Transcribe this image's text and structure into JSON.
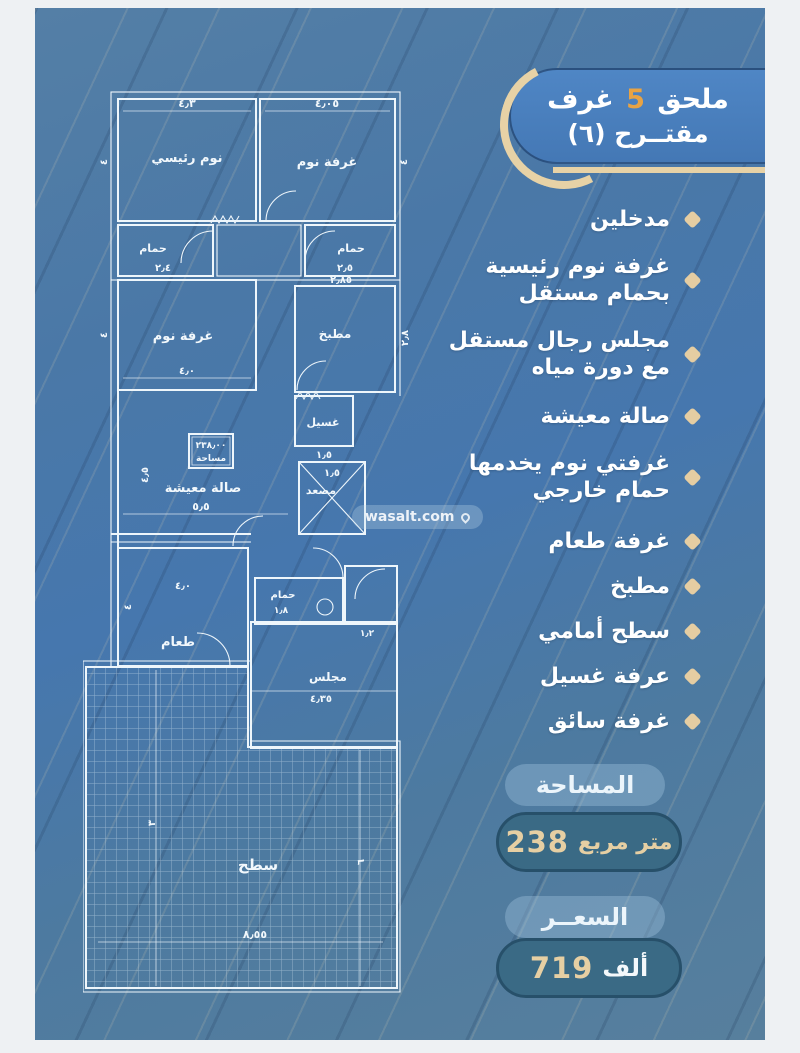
{
  "badge": {
    "line1_prefix": "ملحق",
    "line1_number": "5",
    "line1_suffix": "غرف",
    "line2": "مقتــرح (٦)"
  },
  "features": [
    "مدخلين",
    "غرفة نوم رئيسية\nبحمام مستقل",
    "مجلس رجال مستقل\nمع دورة مياه",
    "صالة معيشة",
    "غرفتي نوم يخدمها\nحمام خارجي",
    "غرفة طعام",
    "مطبخ",
    "سطح أمامي",
    "عرفة غسيل",
    "غرفة سائق"
  ],
  "area": {
    "label": "المساحة",
    "number": "238",
    "unit": "متر مربع"
  },
  "price": {
    "label": "السعــر",
    "number": "719",
    "unit": "ألف"
  },
  "watermark": "wasalt.com",
  "colors": {
    "accent_tan": "#e6cfa3",
    "number_orange": "#e8a344",
    "badge_blue": "#4b80bf",
    "pill_teal": "#3a6a85",
    "background_blue": "#4a78a7"
  },
  "floor_plan": {
    "area_box": {
      "line1": "٢٣٨٫٠٠",
      "line2": "مساحة"
    },
    "rooms": {
      "master_bedroom": {
        "label": "نوم رئيسي",
        "dim_top": "٤٫٣",
        "dim_side": "٤"
      },
      "bedroom_2": {
        "label": "غرفة نوم",
        "dim_top": "٤٫٠٥",
        "dim_side": "٤"
      },
      "bath_1": {
        "label": "حمام",
        "dim": "٢٫٤"
      },
      "bath_2": {
        "label": "حمام",
        "dim": "٢٫٥"
      },
      "kitchen": {
        "label": "مطبخ",
        "dim_top": "٢٫٨٥",
        "dim_side": "٢٫٨"
      },
      "bedroom_3": {
        "label": "غرفة نوم",
        "dim": "٤٫٠",
        "dim_side": "٤"
      },
      "laundry": {
        "label": "غسيل",
        "dim": "١٫٥"
      },
      "elevator": {
        "label": "مصعد",
        "dim": "١٫٥"
      },
      "living": {
        "label": "صالة معيشة",
        "dim": "٥٫٥",
        "dim_side": "٤٫٥"
      },
      "bath_3": {
        "label": "حمام",
        "dim": "١٫٨",
        "dim2": "١٫٢"
      },
      "dining": {
        "label": "طعام",
        "dim": "٤٫٠",
        "dim_side": "٤"
      },
      "majlis": {
        "label": "مجلس",
        "dim": "٤٫٣٥"
      },
      "roof": {
        "label": "سطح",
        "dim_bottom": "٨٫٥٥",
        "dim_left": "٣",
        "dim_right": "٦"
      }
    }
  }
}
